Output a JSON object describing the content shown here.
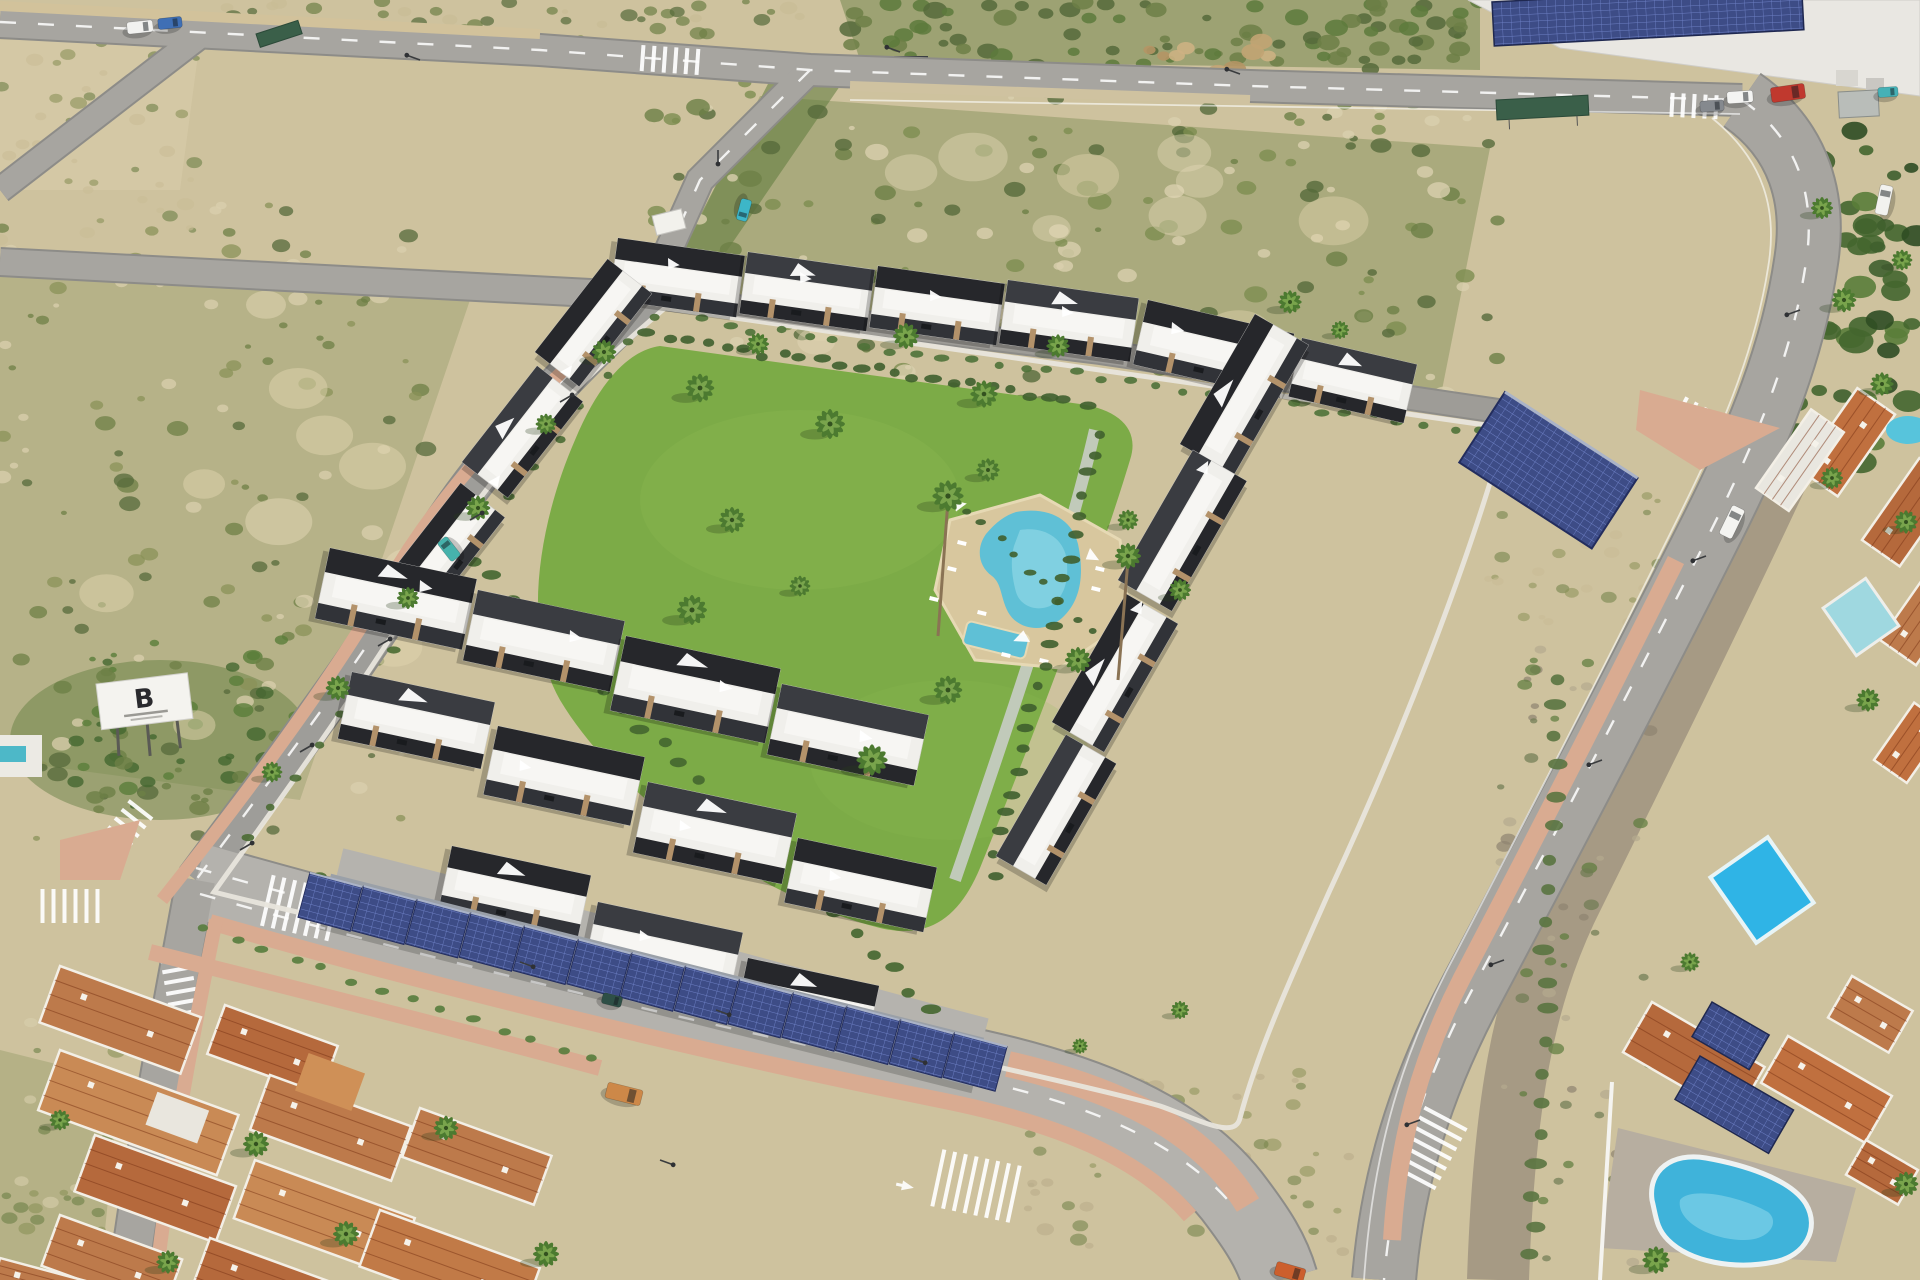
{
  "billboard": {
    "letter": "B"
  },
  "palette": {
    "sand": "#cec29e",
    "sandLight": "#e0d6b4",
    "scrub": "#6d7f46",
    "scrubDark": "#566a3b",
    "field": "#76864c",
    "road": "#a7a5a0",
    "roadLight": "#b4b2ad",
    "roadEdge": "#8d8c88",
    "sidewalkPink": "#d9ab91",
    "sidewalkTan": "#d2c29b",
    "lawn": "#7cab47",
    "lawnLight": "#8fbd55",
    "pool": "#5fc0d6",
    "poolDeep": "#36a8c8",
    "deck": "#d8c79e",
    "white": "#f0efeb",
    "charcoal": "#26272b",
    "stone": "#b3926a",
    "solar": "#3d4c86",
    "solarLine": "#6d7fc4",
    "terracotta": "#bd7a4b",
    "terracottaDark": "#a55f37",
    "wall": "#e8e5dc",
    "channel": "#a69a84",
    "hedge": "#44662f"
  },
  "scrub_zones": [
    [
      0,
      200,
      430,
      640,
      140,
      3,
      11,
      0.75,
      11,
      [
        "#6d7f46",
        "#566a3b",
        "#8a9158",
        "#d9cfae"
      ]
    ],
    [
      640,
      80,
      860,
      330,
      190,
      3,
      12,
      0.8,
      22,
      [
        "#6d7f46",
        "#566a3b",
        "#7d8d50",
        "#d9cfae"
      ]
    ],
    [
      840,
      0,
      640,
      70,
      90,
      4,
      12,
      0.85,
      33,
      [
        "#5d7a3c",
        "#566a3b",
        "#6d7f46"
      ]
    ],
    [
      180,
      0,
      620,
      40,
      50,
      3,
      9,
      0.7,
      44,
      [
        "#6d7f46",
        "#566a3b",
        "#c9bc96"
      ]
    ],
    [
      1020,
      1070,
      330,
      190,
      60,
      3,
      9,
      0.55,
      55,
      [
        "#8a9158",
        "#b8ab88",
        "#6d7f46"
      ]
    ],
    [
      1500,
      648,
      150,
      620,
      80,
      3,
      8,
      0.7,
      66,
      [
        "#b5a98f",
        "#8f8371",
        "#6f7b52",
        "#5d7a3c"
      ]
    ],
    [
      1795,
      125,
      125,
      340,
      60,
      7,
      18,
      0.9,
      77,
      [
        "#3f5f2d",
        "#44662f",
        "#5a7d3a",
        "#2f4d24"
      ]
    ],
    [
      0,
      40,
      200,
      200,
      40,
      3,
      9,
      0.6,
      88,
      [
        "#6d7f46",
        "#c9bc96",
        "#8a9158"
      ]
    ],
    [
      0,
      1000,
      140,
      280,
      40,
      3,
      9,
      0.6,
      99,
      [
        "#6d7f46",
        "#8a9158",
        "#d9cfae"
      ]
    ],
    [
      60,
      640,
      240,
      170,
      60,
      3,
      10,
      0.8,
      111,
      [
        "#44662f",
        "#5a7d3a",
        "#6d7f46"
      ]
    ],
    [
      1480,
      460,
      200,
      170,
      40,
      3,
      8,
      0.55,
      122,
      [
        "#8a9158",
        "#6d7f46",
        "#c9bc96"
      ]
    ],
    [
      100,
      280,
      320,
      480,
      10,
      18,
      36,
      0.5,
      133,
      [
        "#e3d8b6",
        "#dfd3ae"
      ]
    ],
    [
      700,
      130,
      680,
      240,
      12,
      18,
      36,
      0.45,
      144,
      [
        "#e3d8b6",
        "#dfd3ae"
      ]
    ],
    [
      1120,
      40,
      160,
      60,
      14,
      5,
      12,
      0.9,
      155,
      [
        "#cdb183",
        "#c2a473",
        "#b59565"
      ]
    ]
  ],
  "hedge_lines": [
    [
      650,
      336,
      1085,
      402,
      24,
      7,
      "#3f5f2d"
    ],
    [
      1098,
      432,
      992,
      876,
      22,
      7,
      "#3f5f2d"
    ],
    [
      452,
      540,
      930,
      1008,
      26,
      8,
      "#44662f"
    ],
    [
      322,
      878,
      988,
      1054,
      26,
      7,
      "#4a6c33"
    ],
    [
      1560,
      676,
      1532,
      1256,
      20,
      9,
      "#5a7440"
    ],
    [
      652,
      314,
      248,
      838,
      18,
      6,
      "#4a6c33"
    ],
    [
      700,
      322,
      1480,
      432,
      30,
      6,
      "#4f7238"
    ],
    [
      206,
      928,
      590,
      1060,
      14,
      6,
      "#567c3c"
    ],
    [
      968,
      508,
      1108,
      648,
      10,
      5,
      "#3f5f2d"
    ]
  ],
  "palms": [
    [
      700,
      388,
      1.1
    ],
    [
      758,
      344,
      0.85
    ],
    [
      830,
      424,
      1.15
    ],
    [
      906,
      336,
      1.0
    ],
    [
      984,
      394,
      1.05
    ],
    [
      1058,
      346,
      0.9
    ],
    [
      732,
      520,
      1.0
    ],
    [
      692,
      610,
      1.15
    ],
    [
      800,
      586,
      0.8
    ],
    [
      948,
      690,
      1.1
    ],
    [
      1078,
      660,
      1.0
    ],
    [
      872,
      760,
      1.2
    ],
    [
      988,
      470,
      0.9
    ],
    [
      1128,
      520,
      0.8
    ],
    [
      1180,
      590,
      0.85
    ],
    [
      948,
      496,
      1.2
    ],
    [
      1128,
      556,
      1.0
    ],
    [
      604,
      352,
      0.95
    ],
    [
      546,
      424,
      0.8
    ],
    [
      478,
      508,
      0.95
    ],
    [
      408,
      598,
      0.85
    ],
    [
      338,
      688,
      0.95
    ],
    [
      272,
      772,
      0.8
    ],
    [
      256,
      1144,
      1.0
    ],
    [
      346,
      1234,
      1.0
    ],
    [
      168,
      1262,
      0.9
    ],
    [
      446,
      1128,
      0.95
    ],
    [
      546,
      1254,
      1.0
    ],
    [
      60,
      1120,
      0.8
    ],
    [
      1656,
      1260,
      1.05
    ],
    [
      1906,
      1184,
      0.95
    ],
    [
      1868,
      700,
      0.9
    ],
    [
      1832,
      478,
      0.85
    ],
    [
      1906,
      522,
      0.9
    ],
    [
      1690,
      962,
      0.75
    ],
    [
      1844,
      300,
      0.95
    ],
    [
      1882,
      384,
      0.9
    ],
    [
      1822,
      208,
      0.85
    ],
    [
      1902,
      260,
      0.8
    ],
    [
      1290,
      302,
      0.9
    ],
    [
      1340,
      330,
      0.7
    ],
    [
      1180,
      1010,
      0.7
    ],
    [
      1080,
      1046,
      0.6
    ]
  ],
  "buildings": [
    [
      618,
      238,
      8,
      128,
      62,
      0
    ],
    [
      748,
      252,
      8,
      128,
      62,
      1
    ],
    [
      878,
      266,
      8,
      128,
      62,
      0
    ],
    [
      1008,
      280,
      8,
      132,
      64,
      1
    ],
    [
      1148,
      300,
      13,
      150,
      66,
      0
    ],
    [
      1302,
      338,
      13,
      118,
      60,
      1
    ],
    [
      535,
      352,
      -52,
      118,
      56,
      0
    ],
    [
      462,
      462,
      -52,
      122,
      58,
      1
    ],
    [
      388,
      576,
      -52,
      118,
      56,
      0
    ],
    [
      1180,
      444,
      -60,
      150,
      62,
      0
    ],
    [
      1118,
      580,
      -60,
      150,
      62,
      1
    ],
    [
      1052,
      722,
      -60,
      148,
      60,
      0
    ],
    [
      996,
      856,
      -60,
      140,
      58,
      1
    ],
    [
      330,
      548,
      12,
      150,
      72,
      0
    ],
    [
      478,
      590,
      12,
      150,
      72,
      1
    ],
    [
      626,
      636,
      12,
      158,
      76,
      0
    ],
    [
      782,
      684,
      12,
      150,
      72,
      1
    ],
    [
      352,
      672,
      12,
      146,
      68,
      1
    ],
    [
      498,
      726,
      12,
      150,
      70,
      0
    ],
    [
      648,
      782,
      12,
      152,
      72,
      1
    ],
    [
      798,
      838,
      12,
      142,
      66,
      0
    ],
    [
      452,
      846,
      12,
      142,
      64,
      0
    ],
    [
      598,
      902,
      12,
      148,
      66,
      1
    ],
    [
      748,
      958,
      12,
      134,
      62,
      0
    ]
  ],
  "carport": {
    "x1": 330,
    "y1": 902,
    "x2": 975,
    "y2": 1062,
    "n": 13,
    "w": 54,
    "h": 46,
    "rot": 15
  },
  "crosswalks": [
    [
      670,
      60,
      4,
      6,
      26
    ],
    [
      120,
      836,
      -52,
      7,
      30
    ],
    [
      70,
      906,
      0,
      6,
      34
    ],
    [
      180,
      986,
      80,
      6,
      30
    ],
    [
      300,
      908,
      13,
      7,
      52
    ],
    [
      976,
      1186,
      12,
      8,
      58
    ],
    [
      1430,
      1148,
      -62,
      7,
      48
    ],
    [
      1700,
      420,
      28,
      5,
      28
    ],
    [
      1694,
      106,
      3,
      5,
      24
    ]
  ],
  "roofs": [
    [
      60,
      966,
      20,
      150,
      60,
      "#bd7a4b",
      "sw"
    ],
    [
      225,
      1005,
      20,
      120,
      52,
      "#b5693c",
      "sw"
    ],
    [
      60,
      1050,
      20,
      190,
      64,
      "#c98a55",
      "sw"
    ],
    [
      270,
      1075,
      20,
      150,
      58,
      "#bd7a4b",
      "sw"
    ],
    [
      95,
      1135,
      20,
      150,
      60,
      "#b5693c",
      "sw"
    ],
    [
      255,
      1160,
      20,
      170,
      62,
      "#c98a55",
      "sw"
    ],
    [
      60,
      1215,
      20,
      130,
      54,
      "#bd7a4b",
      "sw"
    ],
    [
      210,
      1238,
      20,
      150,
      56,
      "#b5693c",
      "sw"
    ],
    [
      380,
      1210,
      20,
      170,
      60,
      "#c17a47",
      "sw"
    ],
    [
      420,
      1108,
      20,
      140,
      52,
      "#bd7a4b",
      "sw"
    ],
    [
      0,
      1258,
      15,
      90,
      30,
      "#bd7a4b",
      "sw"
    ],
    [
      1652,
      1002,
      30,
      130,
      58,
      "#b5693c",
      "se"
    ],
    [
      1788,
      1036,
      30,
      120,
      54,
      "#c0703f",
      "se"
    ],
    [
      1852,
      976,
      30,
      70,
      48,
      "#bd7a4b",
      "se"
    ],
    [
      1866,
      1140,
      30,
      60,
      40,
      "#b5693c",
      "se"
    ],
    [
      1800,
      470,
      -55,
      100,
      46,
      "#c0703f",
      "se"
    ],
    [
      1862,
      540,
      -55,
      100,
      46,
      "#b5693c",
      "se"
    ],
    [
      1880,
      640,
      -55,
      80,
      44,
      "#bd7a4b",
      "se"
    ],
    [
      1874,
      760,
      -55,
      70,
      40,
      "#c0703f",
      "se"
    ],
    [
      1756,
      488,
      -55,
      96,
      40,
      "#e9e7e0",
      "se"
    ]
  ],
  "solar_rects": [
    [
      1712,
      1002,
      30,
      66,
      40
    ],
    [
      1700,
      1056,
      30,
      108,
      50
    ],
    [
      1492,
      2,
      -3,
      310,
      44
    ]
  ],
  "sails": [
    [
      952,
      500,
      -10,
      1
    ],
    [
      1090,
      548,
      30,
      1
    ],
    [
      1030,
      642,
      160,
      1.1
    ],
    [
      668,
      258,
      8,
      0.9
    ],
    [
      800,
      272,
      8,
      0.9
    ],
    [
      930,
      290,
      8,
      0.9
    ],
    [
      1062,
      306,
      8,
      0.9
    ],
    [
      1172,
      322,
      13,
      1
    ],
    [
      560,
      372,
      -52,
      0.9
    ],
    [
      488,
      482,
      -52,
      0.9
    ],
    [
      1196,
      470,
      -60,
      1
    ],
    [
      1130,
      610,
      -60,
      1
    ],
    [
      420,
      580,
      12,
      1
    ],
    [
      570,
      630,
      12,
      1
    ],
    [
      720,
      680,
      12,
      1
    ],
    [
      860,
      730,
      12,
      1
    ],
    [
      520,
      760,
      12,
      0.9
    ],
    [
      680,
      820,
      12,
      0.9
    ],
    [
      830,
      870,
      12,
      0.9
    ],
    [
      640,
      930,
      12,
      0.9
    ]
  ],
  "vehicles": [
    [
      140,
      27,
      -6,
      26,
      12,
      "#f2f2f0"
    ],
    [
      170,
      23,
      -6,
      24,
      11,
      "#3f6fb5"
    ],
    [
      449,
      549,
      -128,
      24,
      12,
      "#46b2ac"
    ],
    [
      744,
      210,
      105,
      22,
      11,
      "#3db6c8"
    ],
    [
      1740,
      97,
      -4,
      26,
      12,
      "#f4f4f2"
    ],
    [
      1712,
      106,
      -4,
      24,
      11,
      "#85898e"
    ],
    [
      1788,
      93,
      -8,
      34,
      15,
      "#c0392e"
    ],
    [
      1888,
      92,
      -4,
      20,
      10,
      "#45b1b6"
    ],
    [
      1884,
      200,
      -78,
      30,
      13,
      "#f2f2ef"
    ],
    [
      1732,
      522,
      -64,
      32,
      14,
      "#f4f4f1"
    ],
    [
      624,
      1094,
      14,
      36,
      16,
      "#cd8848"
    ],
    [
      1290,
      1272,
      16,
      30,
      14,
      "#cc5f2d"
    ],
    [
      612,
      1000,
      14,
      20,
      11,
      "#2e4f46"
    ]
  ],
  "lamps": [
    [
      420,
      60,
      200
    ],
    [
      900,
      52,
      200
    ],
    [
      1240,
      74,
      200
    ],
    [
      718,
      150,
      90
    ],
    [
      560,
      402,
      -30
    ],
    [
      470,
      520,
      -30
    ],
    [
      378,
      646,
      -30
    ],
    [
      300,
      752,
      -30
    ],
    [
      240,
      850,
      -30
    ],
    [
      520,
      962,
      20
    ],
    [
      716,
      1010,
      20
    ],
    [
      912,
      1058,
      20
    ],
    [
      660,
      1160,
      20
    ],
    [
      1800,
      310,
      160
    ],
    [
      1706,
      556,
      160
    ],
    [
      1602,
      760,
      160
    ],
    [
      1504,
      960,
      160
    ],
    [
      1420,
      1120,
      160
    ]
  ]
}
